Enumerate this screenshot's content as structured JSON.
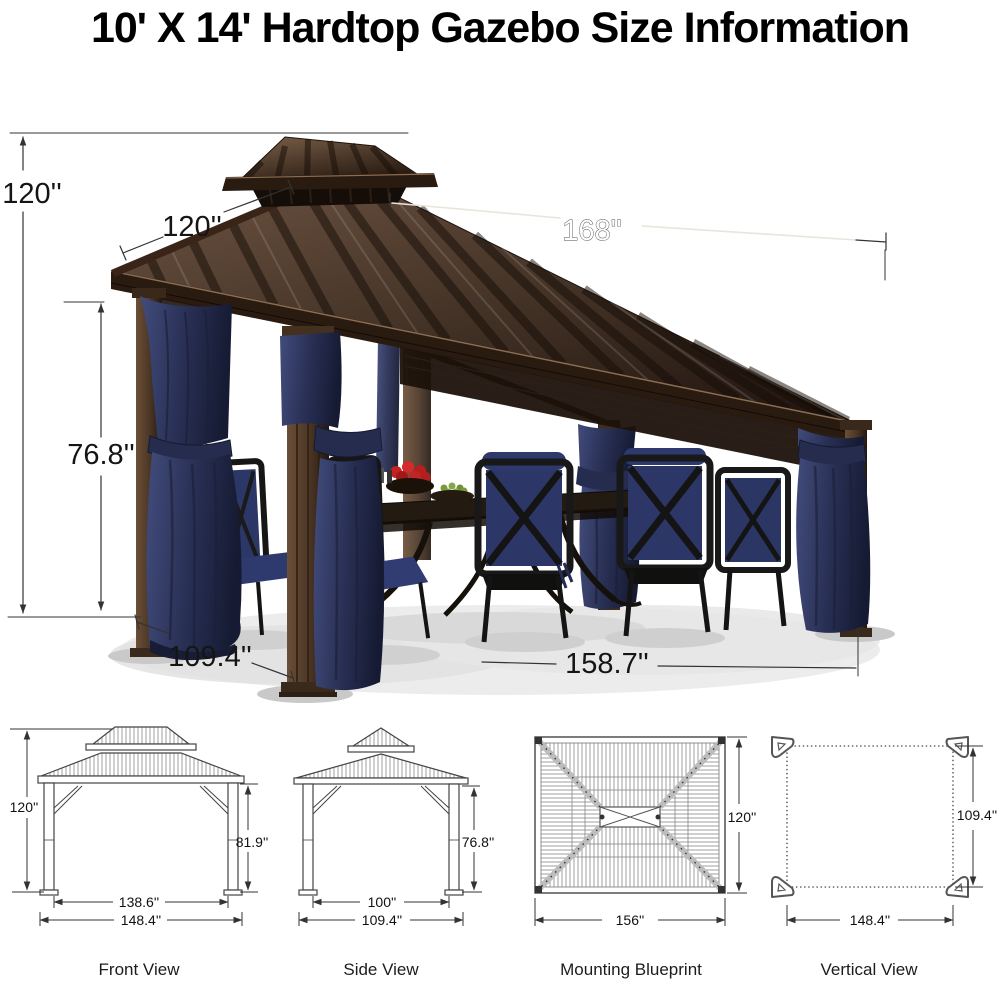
{
  "title": "10' X 14' Hardtop Gazebo Size Information",
  "photo": {
    "labels": {
      "height": "120''",
      "roof_side": "120''",
      "roof_front": "168''",
      "post_height": "76.8''",
      "base_depth": "109.4''",
      "base_width": "158.7''"
    }
  },
  "views": [
    {
      "caption": "Front View",
      "height": "120''",
      "post_height": "81.9''",
      "inner_width": "138.6''",
      "outer_width": "148.4''"
    },
    {
      "caption": "Side View",
      "post_height": "76.8''",
      "inner_width": "100''",
      "outer_width": "109.4''"
    },
    {
      "caption": "Mounting Blueprint",
      "height": "120''",
      "width": "156''"
    },
    {
      "caption": "Vertical View",
      "height": "109.4''",
      "width": "148.4''"
    }
  ],
  "colors": {
    "roof_dark": "#241711",
    "roof_light": "#6b5140",
    "curtain_navy": "#272e52",
    "cushion_navy": "#2c3767",
    "dimension_line": "#333333"
  }
}
